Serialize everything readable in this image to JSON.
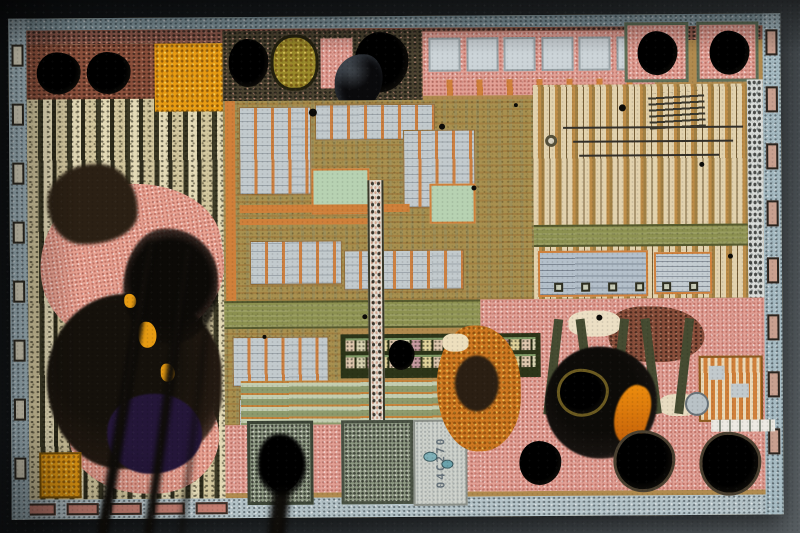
{
  "meta": {
    "subject": "Decapped integrated-circuit silicon die photographed under a microscope",
    "description": "Partially corroded mixed-signal IC die: pink/salmon corrosion and burnt black residue on the left and bottom-right, tan logic circuitry in the center and right, light blue-gray seal ring around the edge, dark out-of-focus bond wires hanging over the lower half",
    "width_px": 800,
    "height_px": 533
  },
  "die": {
    "marking": "04C270"
  },
  "palette": {
    "bg-dark": "#0f1214",
    "bg-mid": "#2c3134",
    "bg-light": "#5d6468",
    "seal": "#a7bcc4",
    "seal-top": "#8ba1a9",
    "seal-bottom": "#b6c5ca",
    "die-tan": "#b08a4e",
    "logic-olive": "#a8904f",
    "orange": "#d0803a",
    "orange-bright": "#e79b12",
    "olive-band": "#8c9150",
    "olive-band-dark": "#565a2e",
    "cell-gray": "#c2cacd",
    "cap-gray": "#ccd4d8",
    "plate-gray": "#b4c0cb",
    "mint": "#b7d2b2",
    "khaki": "#d3c79e",
    "stripe-dark": "#3c3a26",
    "salmon": "#e8a292",
    "power-pink": "#e2a095",
    "rust": "#8a4f3b",
    "brown-dark": "#2b2014",
    "black-blob": "#100e0a",
    "purple": "#241639",
    "fuse-dark": "#2c3418",
    "fuse-green": "#7f9a66",
    "white-strip": "#d9dcd9",
    "text-pad": "#cfd3cd",
    "marking-color": "#55636e",
    "wire": "#14110c",
    "gloss-black": "#0a0a0c"
  },
  "features": {
    "left_edge_pads": 8,
    "right_edge_pads": 8,
    "bottom_edge_pads": 5,
    "capacitor_segments": 6,
    "zigzag_traces": 5,
    "power_contact_squares": 6,
    "bond_wires": 4,
    "corner_bond_pads": 4
  }
}
